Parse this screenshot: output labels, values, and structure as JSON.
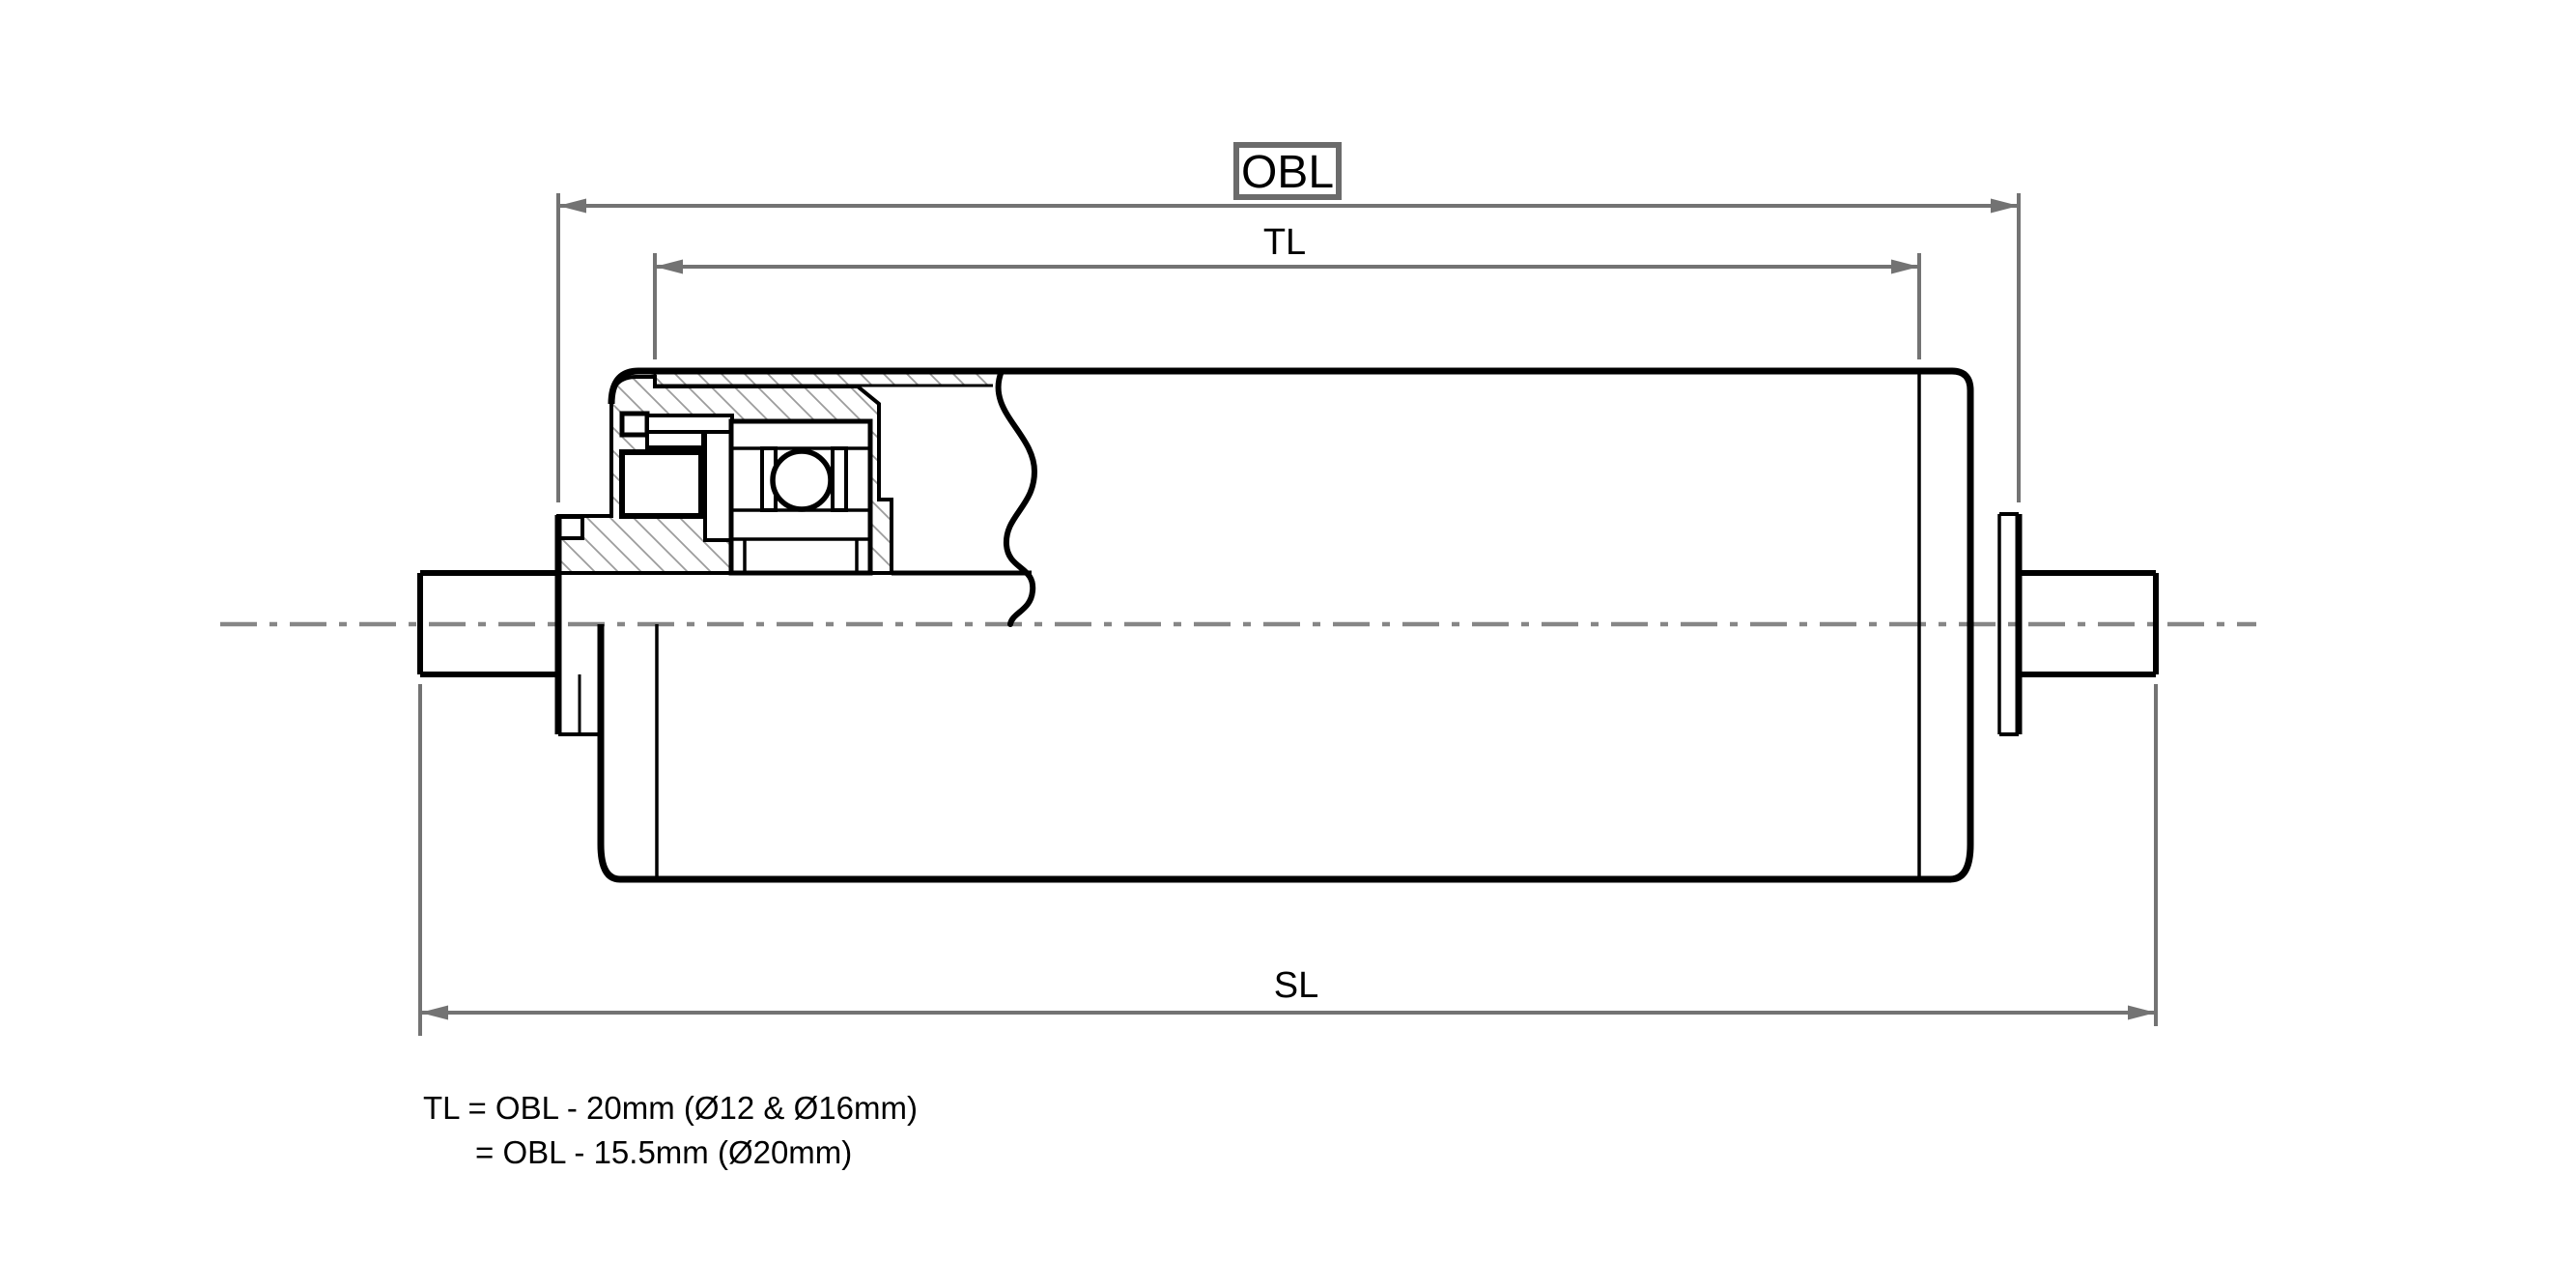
{
  "dimension_labels": {
    "obl": "OBL",
    "tl": "TL",
    "sl": "SL"
  },
  "formulas": {
    "line1": "TL = OBL - 20mm (Ø12 & Ø16mm)",
    "line2": "= OBL - 15.5mm (Ø20mm)"
  },
  "colors": {
    "background": "#ffffff",
    "drawing_line": "#000000",
    "dimension_line": "#737373",
    "obl_box_border": "#6b6b6b",
    "centerline": "#868686",
    "hatch": "#9c9c9c",
    "text": "#000000"
  }
}
